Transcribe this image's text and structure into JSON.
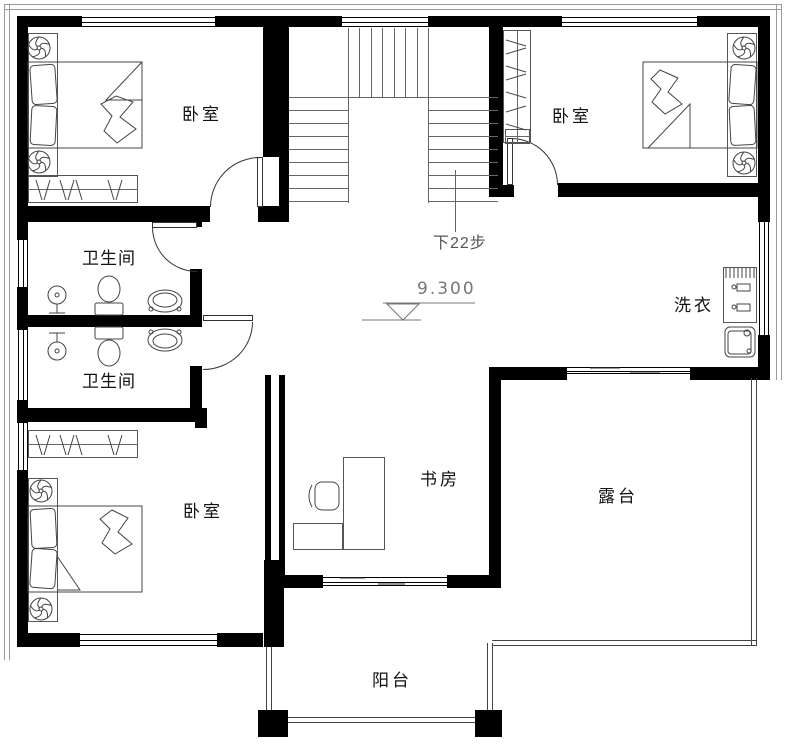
{
  "plan": {
    "labels": {
      "bedroom_tl": "卧室",
      "bedroom_tr": "卧室",
      "bedroom_bl": "卧室",
      "bathroom_upper": "卫生间",
      "bathroom_lower": "卫生间",
      "laundry": "洗衣",
      "study": "书房",
      "terrace": "露台",
      "balcony": "阳台"
    },
    "annotations": {
      "stairs_note": "下22步",
      "elevation": "9.300"
    },
    "colors": {
      "wall": "#000000",
      "furniture_line": "#555555",
      "background": "#ffffff"
    }
  }
}
